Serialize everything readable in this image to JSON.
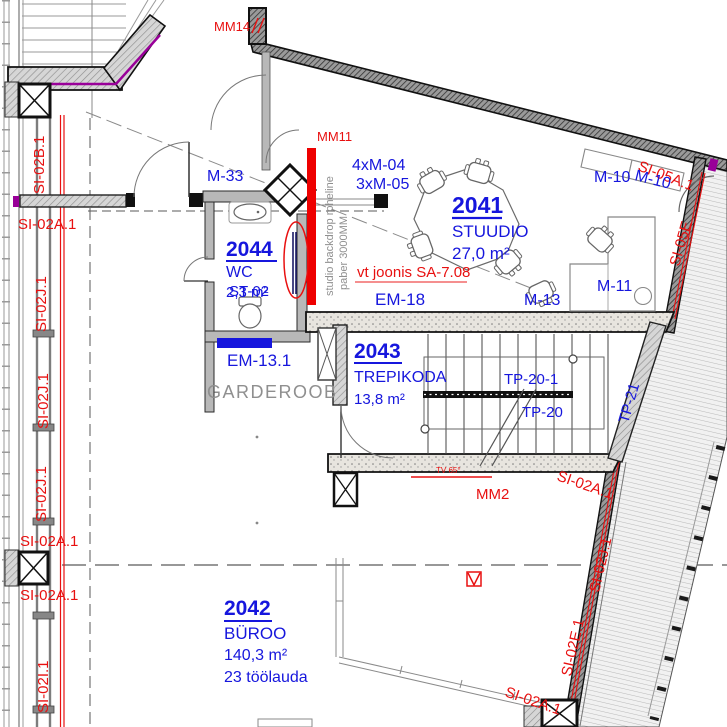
{
  "labels": {
    "rooms": {
      "studio": {
        "number": "2041",
        "name": "STUUDIO",
        "area": "27,0 m²"
      },
      "office": {
        "number": "2042",
        "name": "BÜROO",
        "area": "140,3 m²",
        "note": "23 töölauda"
      },
      "stairs": {
        "number": "2043",
        "name": "TREPIKODA",
        "area": "13,8 m²"
      },
      "wc": {
        "number": "2044",
        "name": "WC",
        "area": "2,3 m²",
        "overlay": "ST-02"
      }
    },
    "zones": {
      "garderoob": "GARDEROOB"
    },
    "furniture": {
      "m33": "M-33",
      "m10": "M-10",
      "m11": "M-11",
      "m13": "M-13",
      "m04": "4xM-04",
      "m05": "3xM-05"
    },
    "elements": {
      "em18": "EM-18",
      "em13": "EM-13.1",
      "tp20": "TP-20",
      "tp20_1": "TP-20-1",
      "tp21": "TP-21"
    },
    "markers": {
      "mm14": "MM14",
      "mm11": "MM11",
      "mm2": "MM2",
      "tv": "TV 65°"
    },
    "sections": {
      "si02a": "SI-02A.1",
      "si02b": "SI-02B.1",
      "si02j": "SI-02J.1",
      "si02i": "SI-02I.1",
      "si02e": "SI-02E.1",
      "si05a": "SI-05A.1",
      "si05e": "SI-05E"
    },
    "annotations": {
      "vt_joonis": "vt joonis SA-7.08",
      "backdrop_1": "studio backdrop roheline",
      "backdrop_2": "paber 3000MM"
    }
  },
  "colors": {
    "label_blue": "#1616dd",
    "marker_red": "#e81010",
    "annotation_gray": "#8f8f8f",
    "insulation_purple": "#990099",
    "backdrop_bar_red": "#ee0000"
  }
}
